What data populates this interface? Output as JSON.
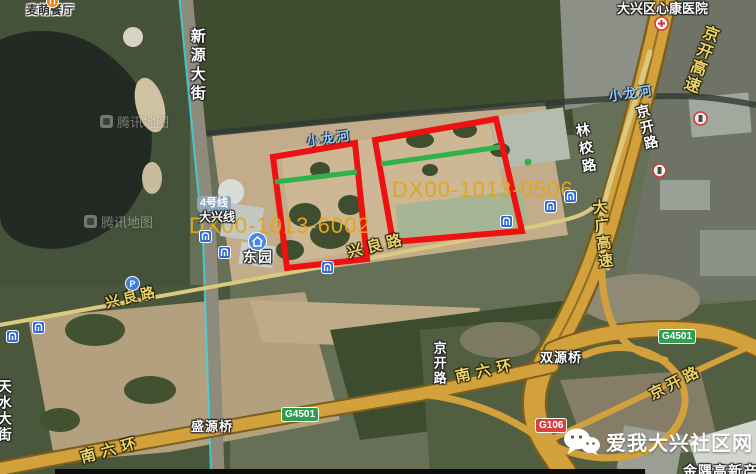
{
  "map_source_watermark": {
    "logo": "tencent-maps-logo",
    "text": "腾讯地图"
  },
  "site_watermark": {
    "icon": "wechat-logo",
    "text": "爱我大兴社区网"
  },
  "parcels": [
    {
      "id": "DX00-1013-6002",
      "label_x": 189,
      "label_y": 213,
      "points": "273,157 355,143 367,259 287,268",
      "green_line": {
        "x1": 275,
        "y1": 182,
        "x2": 357,
        "y2": 172
      }
    },
    {
      "id": "DX00-1013-0506",
      "label_x": 392,
      "label_y": 177,
      "points": "375,140 496,119 522,231 393,242",
      "green_line": {
        "x1": 381,
        "y1": 164,
        "x2": 500,
        "y2": 147
      },
      "green_dot": {
        "x": 528,
        "y": 162
      }
    }
  ],
  "colors": {
    "parcel_outline": "#ee1111",
    "parcel_label": "#e2a51c",
    "green_line": "#2db34a",
    "road_fill": "#d2a13c",
    "metro_line": "#3fd4e0"
  },
  "labels": [
    {
      "name": "poi-label-maimeng-restaurant",
      "text": "麦萌餐厅",
      "cls": "c-dark",
      "x": 26,
      "y": 4,
      "size": 12
    },
    {
      "name": "poi-label-xinkang-hospital",
      "text": "大兴区心康医院",
      "cls": "c-white",
      "x": 617,
      "y": 2,
      "size": 13
    },
    {
      "name": "road-label-xinyuan-street",
      "text": "新源大街",
      "cls": "c-white vert",
      "x": 189,
      "y": 28,
      "size": 15,
      "ls": 4
    },
    {
      "name": "road-label-jingkai-expressway",
      "text": "京开高速",
      "cls": "c-yellow vert",
      "x": 703,
      "y": 22,
      "size": 16,
      "ls": 2,
      "rot": 20
    },
    {
      "name": "road-label-jingkai-road-north",
      "text": "京开路",
      "cls": "c-white vert",
      "x": 634,
      "y": 106,
      "size": 14,
      "ls": 2,
      "rot": -14
    },
    {
      "name": "road-label-linxiao-road",
      "text": "林校路",
      "cls": "c-white vert",
      "x": 574,
      "y": 124,
      "size": 14,
      "ls": 4,
      "rot": -10
    },
    {
      "name": "road-label-daguang-expressway",
      "text": "大广高速",
      "cls": "c-yellow vert",
      "x": 590,
      "y": 200,
      "size": 15,
      "ls": 3,
      "rot": -6
    },
    {
      "name": "river-label-xiaolong-east",
      "text": "小龙河",
      "cls": "c-river",
      "x": 608,
      "y": 90,
      "size": 13,
      "ls": 2,
      "rot": -8
    },
    {
      "name": "river-label-xiaolong-west",
      "text": "小龙河",
      "cls": "c-river",
      "x": 306,
      "y": 135,
      "size": 13,
      "ls": 2,
      "rot": -8
    },
    {
      "name": "road-label-xingliang-west",
      "text": "兴良路",
      "cls": "c-yellow",
      "x": 104,
      "y": 296,
      "size": 14,
      "ls": 4,
      "rot": -13
    },
    {
      "name": "road-label-xingliang-mid",
      "text": "兴良路",
      "cls": "c-yellow",
      "x": 346,
      "y": 246,
      "size": 15,
      "ls": 5,
      "rot": -14
    },
    {
      "name": "station-label-dongyuan",
      "text": "东园",
      "cls": "c-white",
      "x": 243,
      "y": 250,
      "size": 14,
      "ls": 1
    },
    {
      "name": "road-label-tianshui-street",
      "text": "天水大街",
      "cls": "c-white vert",
      "x": -3,
      "y": 379,
      "size": 14,
      "ls": 2
    },
    {
      "name": "bridge-label-shengyuan",
      "text": "盛源桥",
      "cls": "c-white",
      "x": 191,
      "y": 420,
      "size": 13,
      "ls": 1
    },
    {
      "name": "bridge-label-shuangyuan",
      "text": "双源桥",
      "cls": "c-white",
      "x": 540,
      "y": 351,
      "size": 13,
      "ls": 1
    },
    {
      "name": "road-label-south-6th-ring-west",
      "text": "南六环",
      "cls": "c-yellow",
      "x": 79,
      "y": 451,
      "size": 15,
      "ls": 6,
      "rot": -15
    },
    {
      "name": "road-label-south-6th-ring-east",
      "text": "南六环",
      "cls": "c-yellow",
      "x": 454,
      "y": 370,
      "size": 15,
      "ls": 6,
      "rot": -12
    },
    {
      "name": "road-label-jingkai-road-mid",
      "text": "京开路",
      "cls": "c-white vert",
      "x": 432,
      "y": 341,
      "size": 13,
      "ls": 2
    },
    {
      "name": "road-label-jingkai-road-south",
      "text": "京开路",
      "cls": "c-yellow",
      "x": 647,
      "y": 389,
      "size": 15,
      "ls": 4,
      "rot": -27
    },
    {
      "name": "poi-label-jinyu-clipped",
      "text": "金隅高新产",
      "cls": "c-white",
      "x": 683,
      "y": 464,
      "size": 14,
      "ls": 1
    },
    {
      "name": "metro-label-daxing-line",
      "text": "大兴线",
      "cls": "c-white",
      "x": 199,
      "y": 211,
      "size": 12
    }
  ],
  "transit": {
    "line_badge": "4号线",
    "branch_label": "大兴线",
    "station": "东园"
  },
  "badges": [
    {
      "name": "route-badge-g4501-west",
      "text": "G4501",
      "cls": "green",
      "x": 281,
      "y": 407
    },
    {
      "name": "route-badge-g4501-east",
      "text": "G4501",
      "cls": "green",
      "x": 658,
      "y": 329
    },
    {
      "name": "route-badge-g106",
      "text": "G106",
      "cls": "red",
      "x": 535,
      "y": 418
    }
  ],
  "icons": [
    {
      "name": "subway-icon",
      "type": "subway",
      "x": 199,
      "y": 230
    },
    {
      "name": "subway-icon",
      "type": "subway",
      "x": 218,
      "y": 246
    },
    {
      "name": "subway-icon",
      "type": "subway",
      "x": 321,
      "y": 261
    },
    {
      "name": "subway-icon",
      "type": "subway",
      "x": 6,
      "y": 330
    },
    {
      "name": "subway-icon",
      "type": "subway",
      "x": 32,
      "y": 321
    },
    {
      "name": "subway-icon",
      "type": "subway",
      "x": 544,
      "y": 200
    },
    {
      "name": "subway-icon",
      "type": "subway",
      "x": 564,
      "y": 190
    },
    {
      "name": "subway-icon",
      "type": "subway",
      "x": 500,
      "y": 215
    },
    {
      "name": "parking-icon",
      "type": "parking",
      "x": 125,
      "y": 276
    },
    {
      "name": "hospital-icon",
      "type": "hospital",
      "x": 654,
      "y": 16
    },
    {
      "name": "poi-ring-icon",
      "type": "ring",
      "x": 693,
      "y": 111
    },
    {
      "name": "poi-ring-icon",
      "type": "ring",
      "x": 652,
      "y": 163
    },
    {
      "name": "restaurant-icon",
      "type": "restaurant",
      "x": 46,
      "y": -5
    },
    {
      "name": "station-entrance-icon",
      "type": "house",
      "x": 248,
      "y": 232
    }
  ],
  "map_watermarks": [
    {
      "x": 100,
      "y": 112
    },
    {
      "x": 84,
      "y": 212
    }
  ]
}
